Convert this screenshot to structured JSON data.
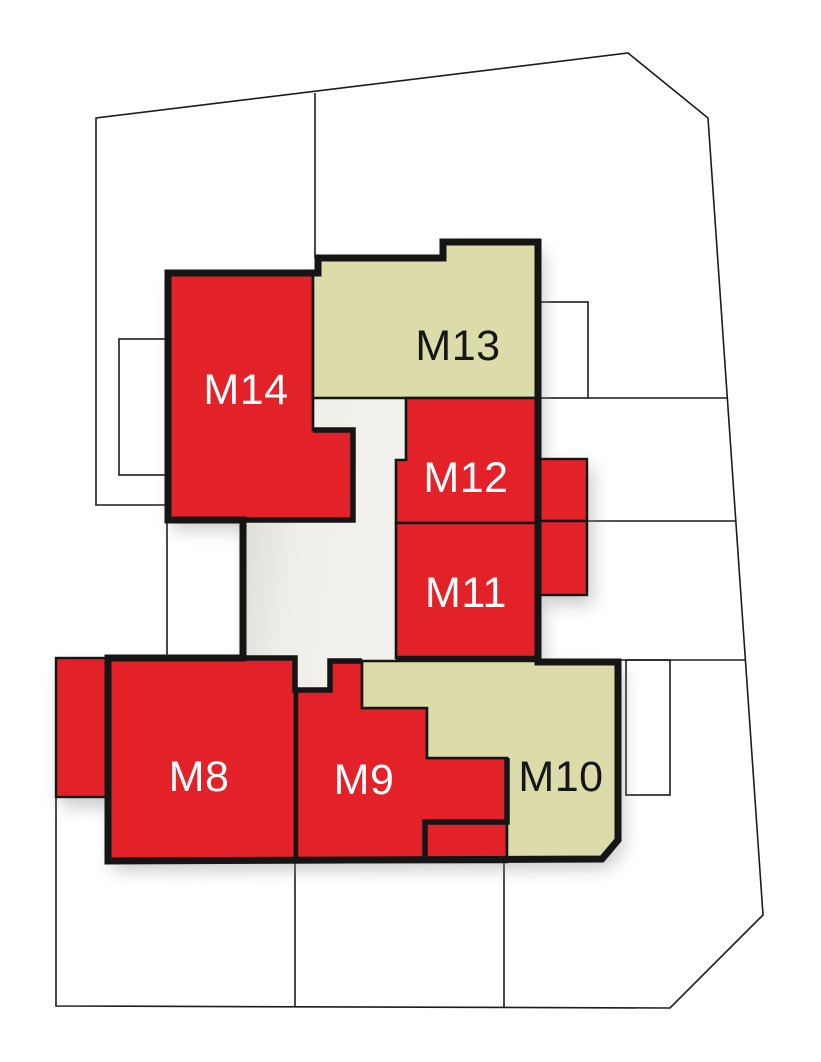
{
  "plan": {
    "title": "Building site plan with unit availability",
    "units": [
      {
        "id": "M14",
        "label": "M14",
        "color": "#e32128",
        "label_color": "#ffffff",
        "status": "unavailable"
      },
      {
        "id": "M13",
        "label": "M13",
        "color": "#dcdcab",
        "label_color": "#161616",
        "status": "available"
      },
      {
        "id": "M12",
        "label": "M12",
        "color": "#e32128",
        "label_color": "#ffffff",
        "status": "unavailable"
      },
      {
        "id": "M11",
        "label": "M11",
        "color": "#e32128",
        "label_color": "#ffffff",
        "status": "unavailable"
      },
      {
        "id": "M8",
        "label": "M8",
        "color": "#e32128",
        "label_color": "#ffffff",
        "status": "unavailable"
      },
      {
        "id": "M9",
        "label": "M9",
        "color": "#e32128",
        "label_color": "#ffffff",
        "status": "unavailable"
      },
      {
        "id": "M10",
        "label": "M10",
        "color": "#dcdcab",
        "label_color": "#161616",
        "status": "available"
      }
    ],
    "palette": {
      "unavailable_red": "#e32128",
      "available_beige": "#dcdcab",
      "courtyard_light": "#f1efe9",
      "outline_black": "#151515",
      "boundary_line": "#1c1c1c",
      "shadow_grey": "#8f8f8f",
      "background": "#ffffff"
    }
  }
}
